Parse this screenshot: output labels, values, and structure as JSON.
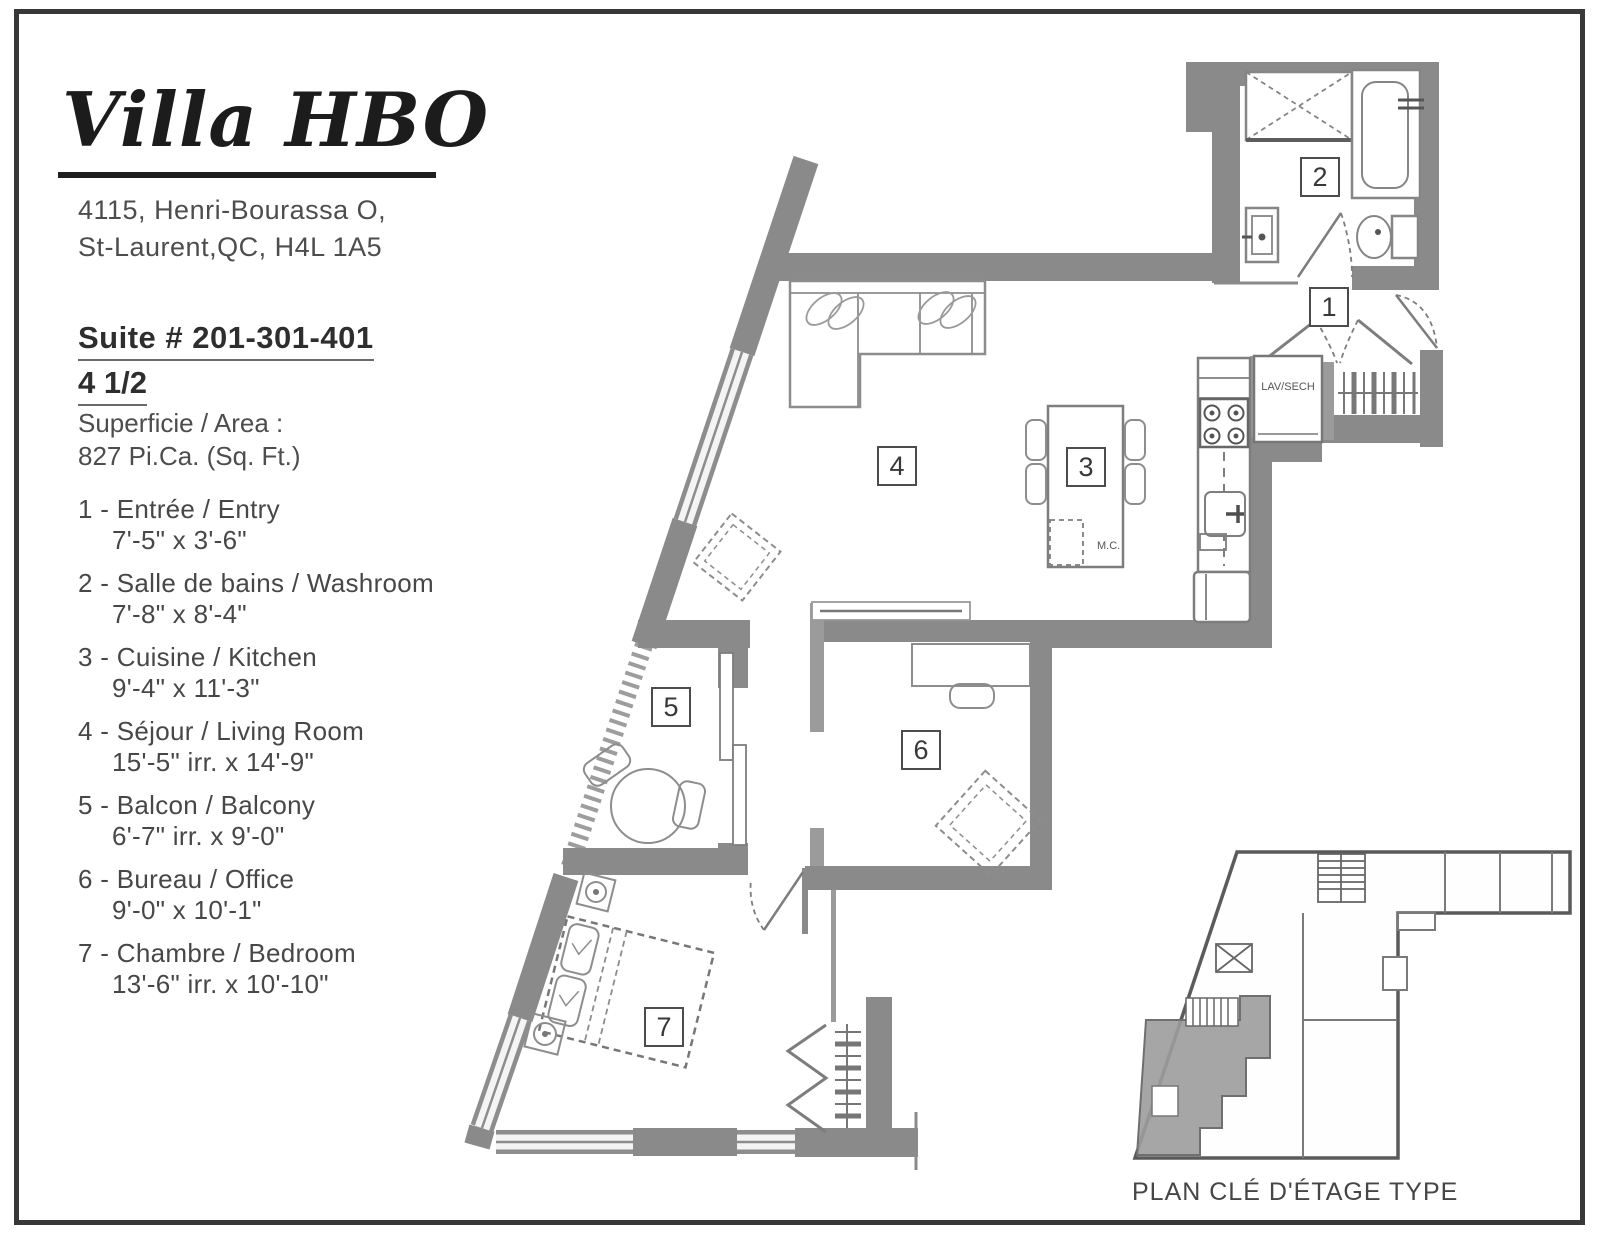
{
  "header": {
    "logo": "Villa HBO",
    "address_lines": [
      "4115, Henri-Bourassa O,",
      "St-Laurent,QC, H4L 1A5"
    ]
  },
  "suite": {
    "title": "Suite # 201-301-401",
    "subtitle": "4 1/2",
    "area_label": "Superficie / Area :",
    "area_value": "827 Pi.Ca. (Sq. Ft.)"
  },
  "legend": [
    {
      "num": "1",
      "line1": "1 - Entrée / Entry",
      "dims": "7'-5\" x 3'-6\""
    },
    {
      "num": "2",
      "line1": "2 - Salle de bains / Washroom",
      "dims": "7'-8\" x 8'-4\""
    },
    {
      "num": "3",
      "line1": "3 - Cuisine / Kitchen",
      "dims": "9'-4\" x 11'-3\""
    },
    {
      "num": "4",
      "line1": "4 - Séjour / Living Room",
      "dims": "15'-5\" irr. x 14'-9\""
    },
    {
      "num": "5",
      "line1": "5 - Balcon / Balcony",
      "dims": "6'-7\" irr. x 9'-0\""
    },
    {
      "num": "6",
      "line1": "6 - Bureau / Office",
      "dims": "9'-0\" x 10'-1\""
    },
    {
      "num": "7",
      "line1": "7 - Chambre / Bedroom",
      "dims": "13'-6\" irr. x 10'-10\""
    }
  ],
  "plan": {
    "labels": {
      "laundry": "LAV/SECH",
      "microwave": "M.C."
    }
  },
  "key_plan": {
    "caption": "PLAN CLÉ D'ÉTAGE TYPE"
  },
  "colors": {
    "wall": "#8a8a8a",
    "wall_light": "#9b9b9b",
    "furniture_line": "#8d8d8d",
    "text": "#454545",
    "page_border": "#383838",
    "keyplan_suite_fill": "#9c9c9c",
    "paper": "#ffffff"
  }
}
